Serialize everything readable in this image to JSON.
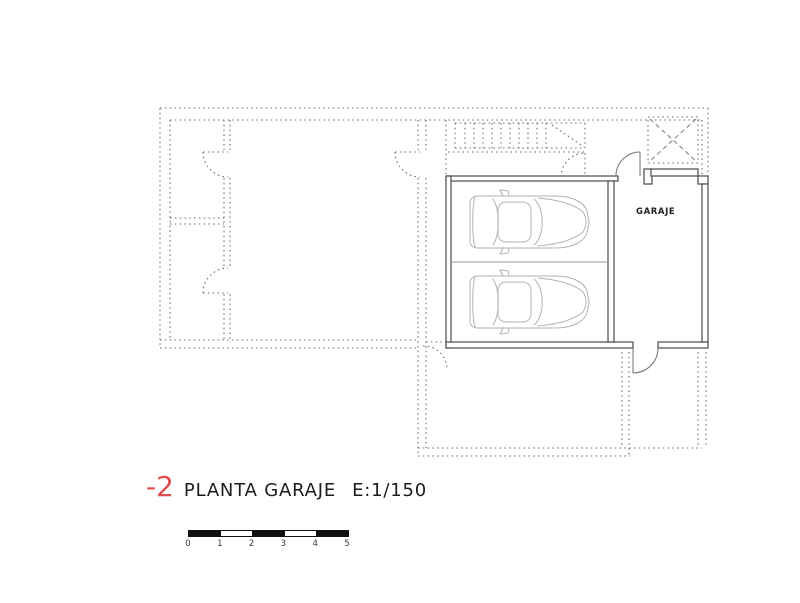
{
  "plan": {
    "room_label": "GARAJE",
    "caption": {
      "floor_number": "-2",
      "title": "PLANTA GARAJE",
      "scale": "E:1/150"
    },
    "scale_bar": {
      "ticks": [
        "0",
        "1",
        "2",
        "3",
        "4",
        "5"
      ]
    }
  },
  "colors": {
    "floor_number": "#e14b4b",
    "caption_text": "#1c1c1c",
    "solid_walls": "#4a4a4a",
    "projection_dotted": "#6f6f6f",
    "car_outline": "#b2b2b2",
    "scale_bar": "#101010"
  }
}
